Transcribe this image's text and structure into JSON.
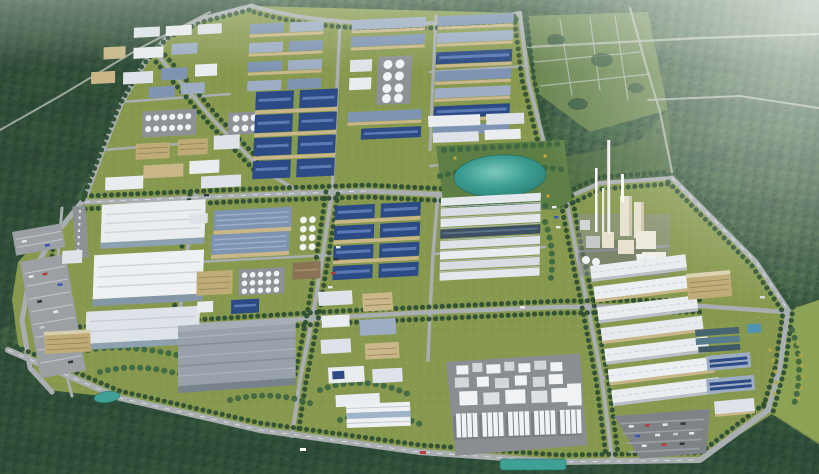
{
  "scene": {
    "title": "Aerial 3D rendering of a planned industrial park surrounded by forested hills",
    "description": "Bird's-eye masterplan visualization: tree-lined boulevard grid, blue-roofed factory halls, white logistics warehouses, a central landscaped lake, a process plant with tall stacks, silo plants, tank farms, parking lots and water-treatment basins, with dense forest and cleared development plots around the campus and atmospheric haze toward the horizon.",
    "landmarks": [
      {
        "name": "forest-hills",
        "label": "Dense forested hills surrounding the park"
      },
      {
        "name": "development-plots",
        "label": "Cleared development plots with road grid (north-east)"
      },
      {
        "name": "road-network",
        "label": "Tree-lined boulevard grid"
      },
      {
        "name": "blue-roof-factories",
        "label": "Navy-blue roofed factory halls"
      },
      {
        "name": "steel-roof-rows",
        "label": "Rows of steel-grey workshop buildings"
      },
      {
        "name": "tank-farm",
        "label": "White storage tank clusters"
      },
      {
        "name": "lake-garden",
        "label": "Central landscaped lake and gardens"
      },
      {
        "name": "chemical-plant",
        "label": "Process plant with tall exhaust stacks"
      },
      {
        "name": "big-white-warehouses",
        "label": "Large white logistics warehouses (west)"
      },
      {
        "name": "grey-warehouse",
        "label": "Large grey distribution warehouse (south-center)"
      },
      {
        "name": "light-shed-rows",
        "label": "Striped light warehouse rows (center & east)"
      },
      {
        "name": "silo-plant",
        "label": "Processing plant with silo rows (south)"
      },
      {
        "name": "water-treatment",
        "label": "Water-treatment basins (east)"
      },
      {
        "name": "parking-west",
        "label": "Surface parking lot with cars (west)"
      },
      {
        "name": "parking-south-east",
        "label": "Surface parking lot with cars (south-east)"
      }
    ],
    "colors": {
      "forest": "#3c5c42",
      "forest_dark": "#223d2f",
      "grass": "#87994f",
      "grass_light": "#93a557",
      "road": "#a9aeb1",
      "tree": "#2d4f33",
      "roof_navy": "#2c4a85",
      "roof_navy_light": "#5b7ab4",
      "roof_steel": "#7e94b2",
      "roof_steel_light": "#9dadc3",
      "roof_white": "#e9edf0",
      "roof_grey": "#99a2ab",
      "wall_beige": "#c9b78a",
      "office_tan": "#bfab76",
      "plant_cream": "#e8e1cf",
      "silo_white": "#f0f2f3",
      "pad_grey": "#8e9296",
      "water": "#3fa096",
      "pond_blue": "#4f93b0",
      "haze": "#f2f6f0"
    }
  }
}
